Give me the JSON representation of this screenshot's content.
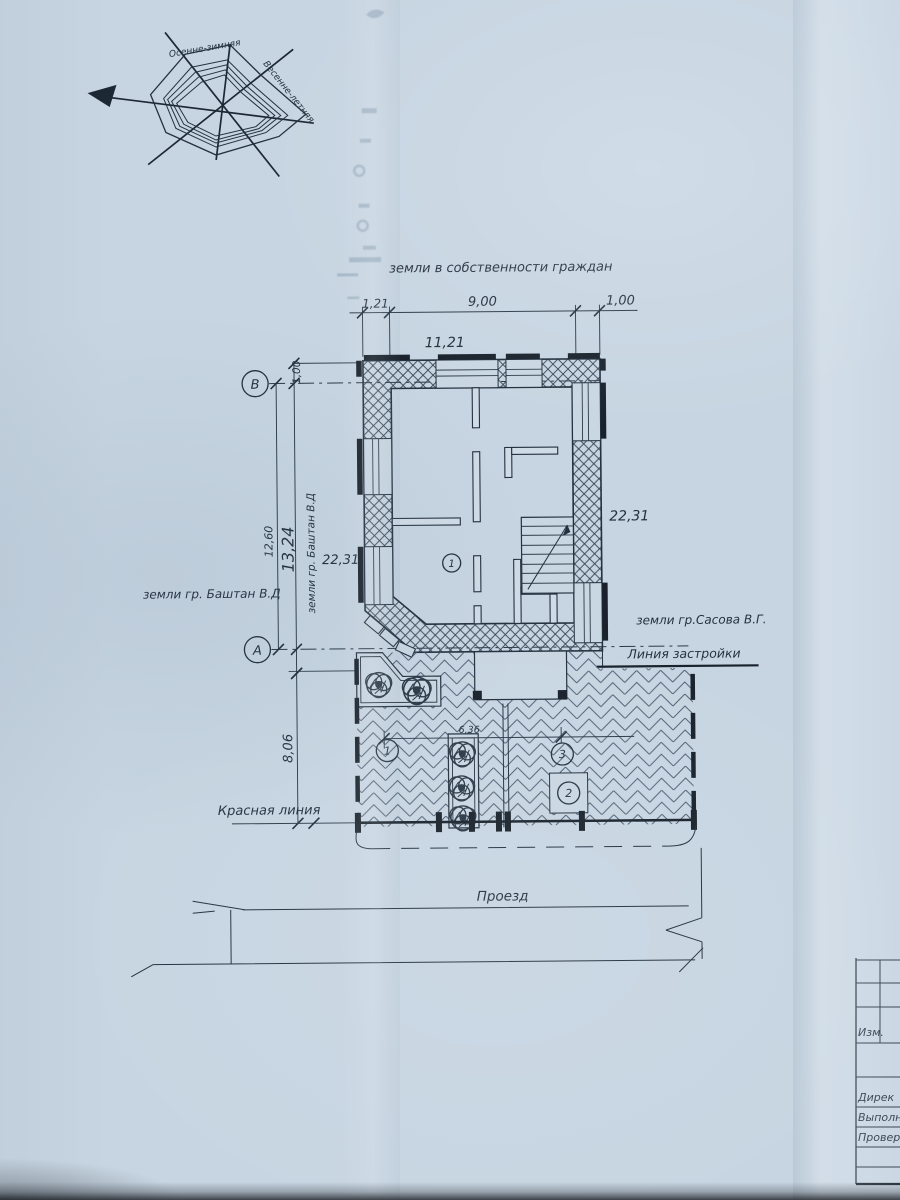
{
  "colors": {
    "paper": "#c7d5e2",
    "ink": "#243140",
    "bars": "#19222c"
  },
  "wind_rose": {
    "autumn_winter": "Осенне-зимняя",
    "spring_summer": "Весенне-летняя"
  },
  "labels": {
    "ownership": "земли в собственности граждан",
    "owner_left": "земли гр. Баштан В.Д",
    "owner_left_vertical": "земли гр. Баштан В.Д",
    "owner_right": "земли гр.Сасова В.Г.",
    "building_line": "Линия застройки",
    "red_line": "Красная линия",
    "road": "Проезд"
  },
  "dimensions": {
    "top_seg1": "1,21",
    "top_seg2": "9,00",
    "top_seg3": "1,00",
    "top_total": "11,21",
    "offset_b": "1,00",
    "left_inner": "12,60",
    "left_total": "13,24",
    "depth_left": "22,31",
    "depth_right": "22,31",
    "front_setback": "8,06",
    "yard_span": "6,36"
  },
  "axes": {
    "row_top": "В",
    "row_bottom": "А"
  },
  "markers": {
    "room": "1",
    "yard1": "1",
    "yard2": "2",
    "yard3": "3"
  },
  "title_block": {
    "change_col": "Изм.",
    "row1": "Дирек",
    "row2": "Выполн",
    "row3": "Провер"
  }
}
